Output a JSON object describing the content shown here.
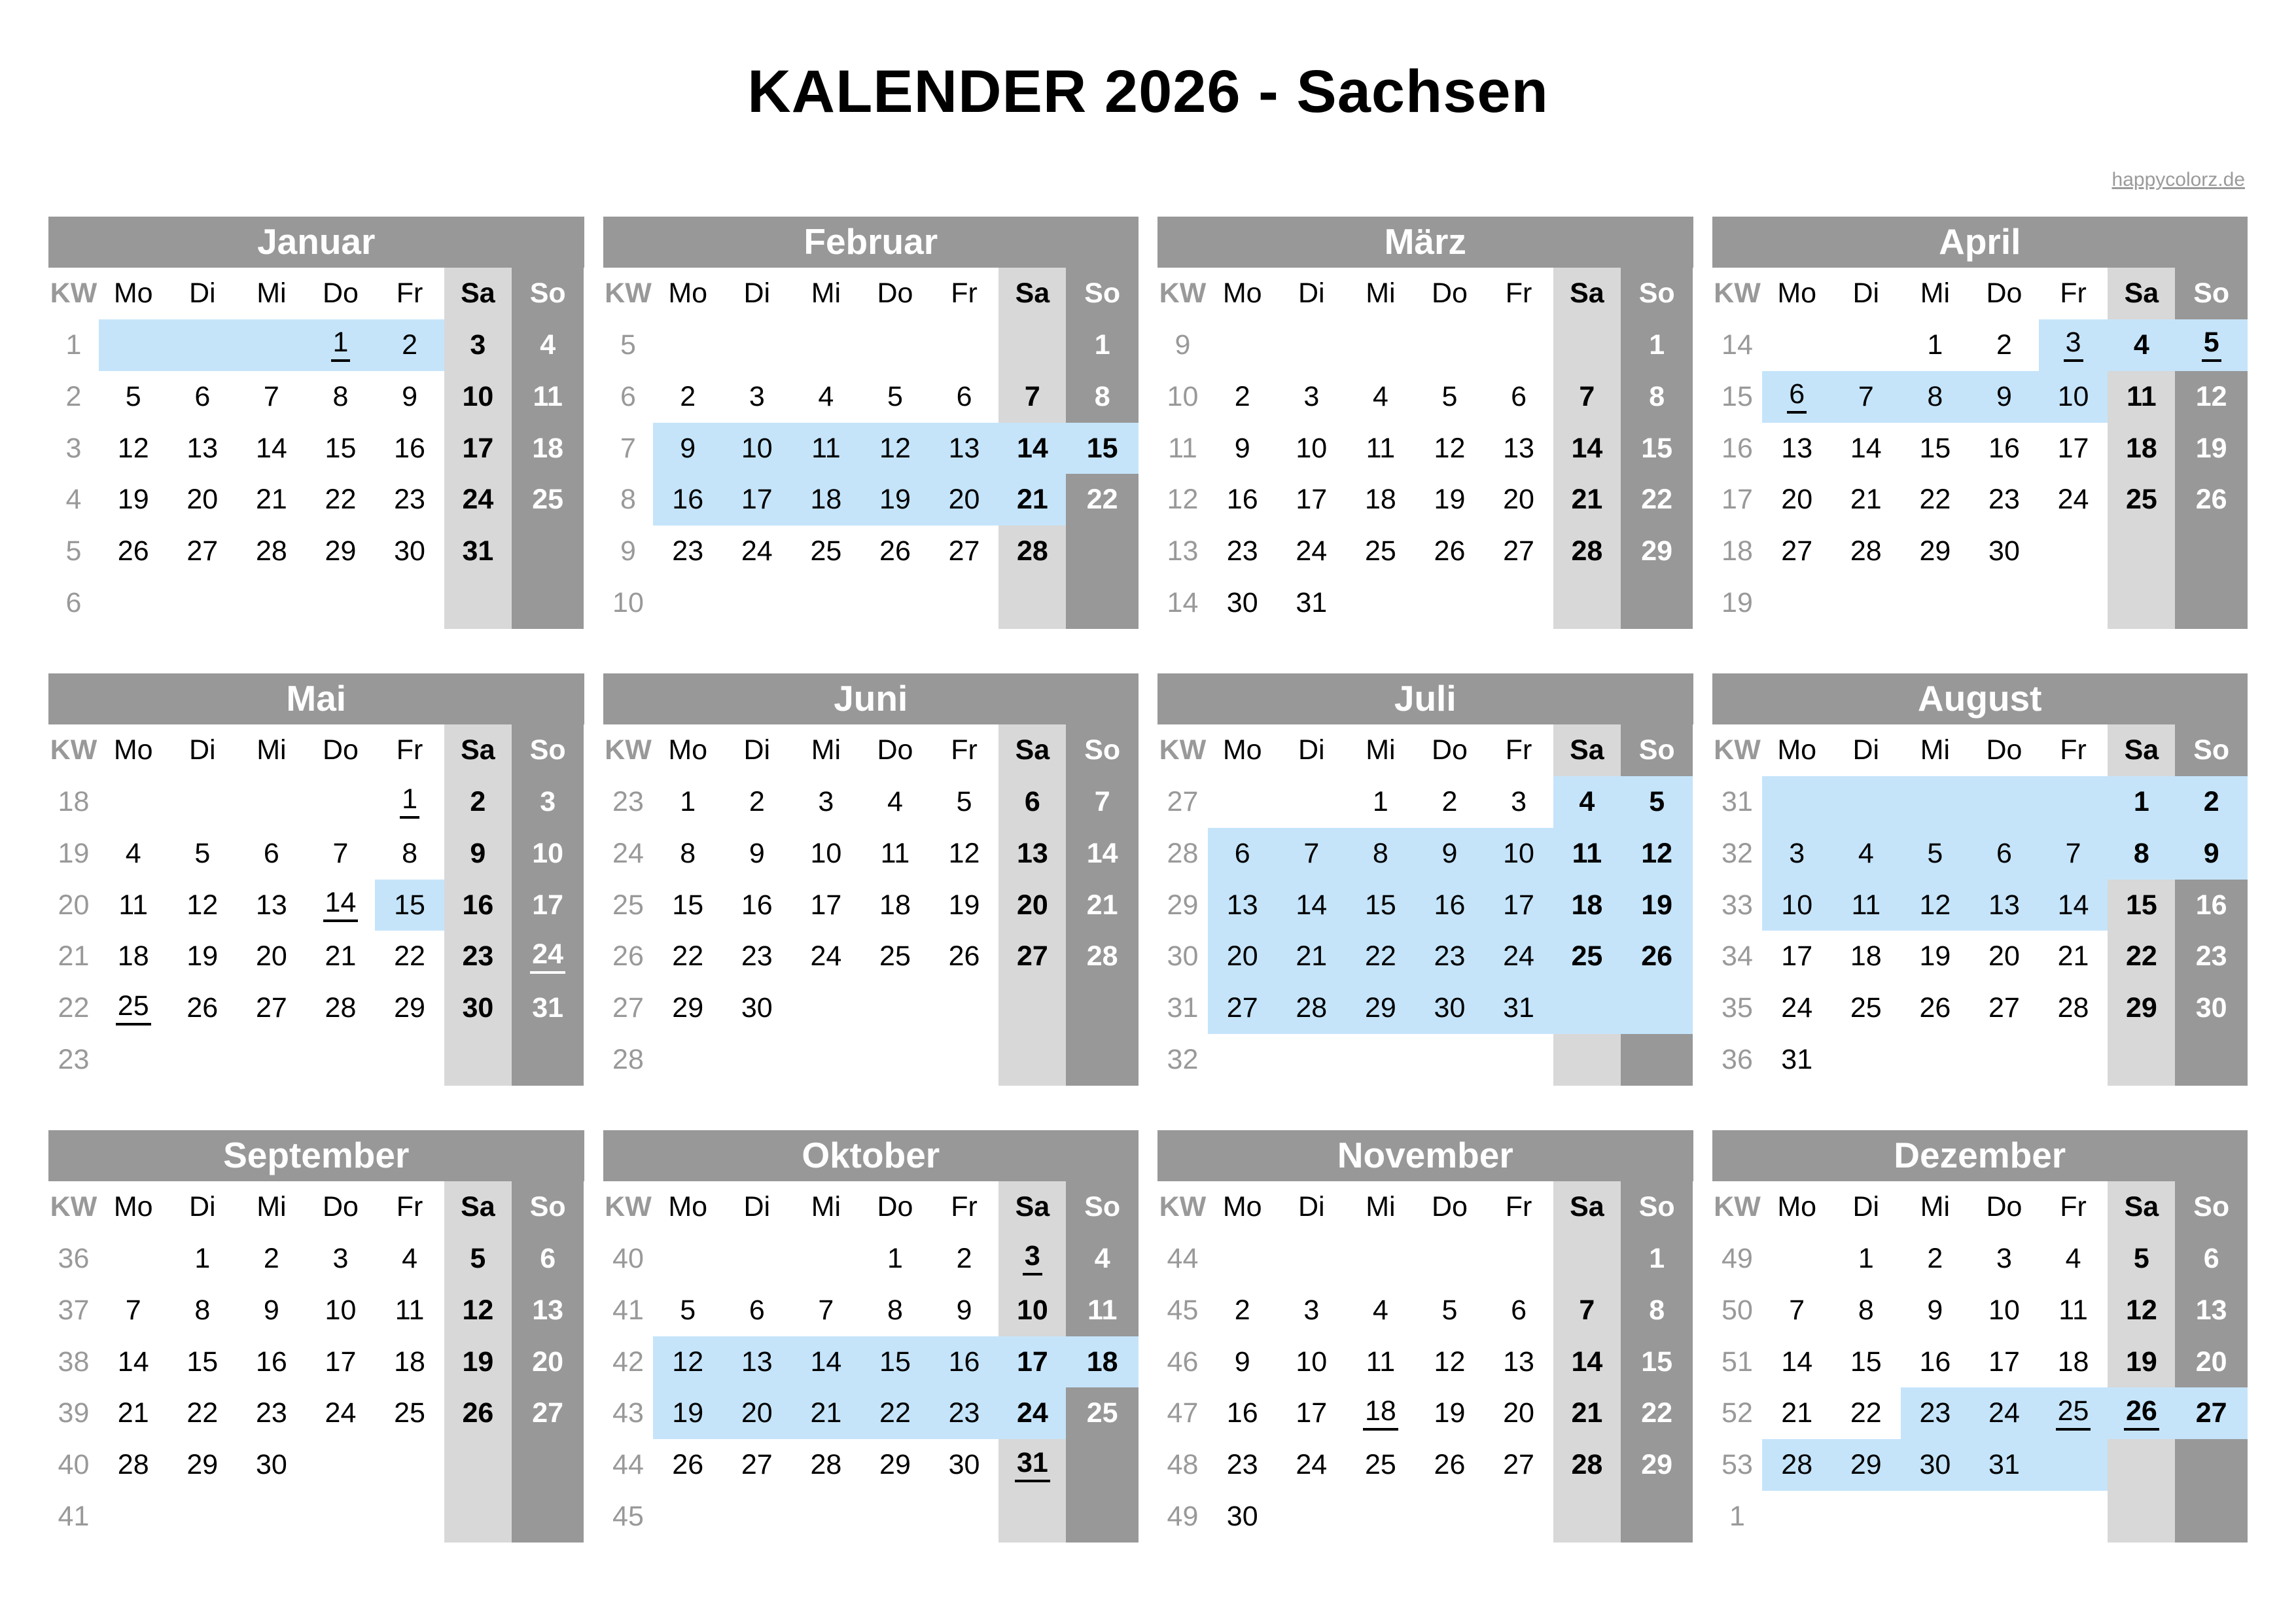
{
  "title": "KALENDER 2026 - Sachsen",
  "link": "happycolorz.de",
  "colors": {
    "header_gray": "#989898",
    "saturday_gray": "#d8d8d8",
    "sunday_gray": "#989898",
    "highlight_blue": "#c5e4fa",
    "kw_text_gray": "#999999"
  },
  "weekday_headers": [
    "KW",
    "Mo",
    "Di",
    "Mi",
    "Do",
    "Fr",
    "Sa",
    "So"
  ],
  "legend_note": "cell token format: digits = day number, u = underlined holiday, h = blue highlight",
  "months": [
    {
      "name": "Januar",
      "kw": [
        "1",
        "2",
        "3",
        "4",
        "5",
        "6"
      ],
      "weeks": [
        [
          "h",
          "h",
          "h",
          "1uh",
          "2h",
          "3",
          "4"
        ],
        [
          "5",
          "6",
          "7",
          "8",
          "9",
          "10",
          "11"
        ],
        [
          "12",
          "13",
          "14",
          "15",
          "16",
          "17",
          "18"
        ],
        [
          "19",
          "20",
          "21",
          "22",
          "23",
          "24",
          "25"
        ],
        [
          "26",
          "27",
          "28",
          "29",
          "30",
          "31",
          ""
        ],
        [
          "",
          "",
          "",
          "",
          "",
          "",
          ""
        ]
      ]
    },
    {
      "name": "Februar",
      "kw": [
        "5",
        "6",
        "7",
        "8",
        "9",
        "10"
      ],
      "weeks": [
        [
          "",
          "",
          "",
          "",
          "",
          "",
          "1"
        ],
        [
          "2",
          "3",
          "4",
          "5",
          "6",
          "7",
          "8"
        ],
        [
          "9h",
          "10h",
          "11h",
          "12h",
          "13h",
          "14h",
          "15h"
        ],
        [
          "16h",
          "17h",
          "18h",
          "19h",
          "20h",
          "21h",
          "22"
        ],
        [
          "23",
          "24",
          "25",
          "26",
          "27",
          "28",
          ""
        ],
        [
          "",
          "",
          "",
          "",
          "",
          "",
          ""
        ]
      ]
    },
    {
      "name": "März",
      "kw": [
        "9",
        "10",
        "11",
        "12",
        "13",
        "14"
      ],
      "weeks": [
        [
          "",
          "",
          "",
          "",
          "",
          "",
          "1"
        ],
        [
          "2",
          "3",
          "4",
          "5",
          "6",
          "7",
          "8"
        ],
        [
          "9",
          "10",
          "11",
          "12",
          "13",
          "14",
          "15"
        ],
        [
          "16",
          "17",
          "18",
          "19",
          "20",
          "21",
          "22"
        ],
        [
          "23",
          "24",
          "25",
          "26",
          "27",
          "28",
          "29"
        ],
        [
          "30",
          "31",
          "",
          "",
          "",
          "",
          ""
        ]
      ]
    },
    {
      "name": "April",
      "kw": [
        "14",
        "15",
        "16",
        "17",
        "18",
        "19"
      ],
      "weeks": [
        [
          "",
          "",
          "1",
          "2",
          "3uh",
          "4h",
          "5uh"
        ],
        [
          "6uh",
          "7h",
          "8h",
          "9h",
          "10h",
          "11",
          "12"
        ],
        [
          "13",
          "14",
          "15",
          "16",
          "17",
          "18",
          "19"
        ],
        [
          "20",
          "21",
          "22",
          "23",
          "24",
          "25",
          "26"
        ],
        [
          "27",
          "28",
          "29",
          "30",
          "",
          "",
          ""
        ],
        [
          "",
          "",
          "",
          "",
          "",
          "",
          ""
        ]
      ]
    },
    {
      "name": "Mai",
      "kw": [
        "18",
        "19",
        "20",
        "21",
        "22",
        "23"
      ],
      "weeks": [
        [
          "",
          "",
          "",
          "",
          "1u",
          "2",
          "3"
        ],
        [
          "4",
          "5",
          "6",
          "7",
          "8",
          "9",
          "10"
        ],
        [
          "11",
          "12",
          "13",
          "14u",
          "15h",
          "16",
          "17"
        ],
        [
          "18",
          "19",
          "20",
          "21",
          "22",
          "23",
          "24u"
        ],
        [
          "25u",
          "26",
          "27",
          "28",
          "29",
          "30",
          "31"
        ],
        [
          "",
          "",
          "",
          "",
          "",
          "",
          ""
        ]
      ]
    },
    {
      "name": "Juni",
      "kw": [
        "23",
        "24",
        "25",
        "26",
        "27",
        "28"
      ],
      "weeks": [
        [
          "1",
          "2",
          "3",
          "4",
          "5",
          "6",
          "7"
        ],
        [
          "8",
          "9",
          "10",
          "11",
          "12",
          "13",
          "14"
        ],
        [
          "15",
          "16",
          "17",
          "18",
          "19",
          "20",
          "21"
        ],
        [
          "22",
          "23",
          "24",
          "25",
          "26",
          "27",
          "28"
        ],
        [
          "29",
          "30",
          "",
          "",
          "",
          "",
          ""
        ],
        [
          "",
          "",
          "",
          "",
          "",
          "",
          ""
        ]
      ]
    },
    {
      "name": "Juli",
      "kw": [
        "27",
        "28",
        "29",
        "30",
        "31",
        "32"
      ],
      "weeks": [
        [
          "",
          "",
          "1",
          "2",
          "3",
          "4h",
          "5h"
        ],
        [
          "6h",
          "7h",
          "8h",
          "9h",
          "10h",
          "11h",
          "12h"
        ],
        [
          "13h",
          "14h",
          "15h",
          "16h",
          "17h",
          "18h",
          "19h"
        ],
        [
          "20h",
          "21h",
          "22h",
          "23h",
          "24h",
          "25h",
          "26h"
        ],
        [
          "27h",
          "28h",
          "29h",
          "30h",
          "31h",
          "h",
          "h"
        ],
        [
          "",
          "",
          "",
          "",
          "",
          "",
          ""
        ]
      ]
    },
    {
      "name": "August",
      "kw": [
        "31",
        "32",
        "33",
        "34",
        "35",
        "36"
      ],
      "weeks": [
        [
          "h",
          "h",
          "h",
          "h",
          "h",
          "1h",
          "2h"
        ],
        [
          "3h",
          "4h",
          "5h",
          "6h",
          "7h",
          "8h",
          "9h"
        ],
        [
          "10h",
          "11h",
          "12h",
          "13h",
          "14h",
          "15",
          "16"
        ],
        [
          "17",
          "18",
          "19",
          "20",
          "21",
          "22",
          "23"
        ],
        [
          "24",
          "25",
          "26",
          "27",
          "28",
          "29",
          "30"
        ],
        [
          "31",
          "",
          "",
          "",
          "",
          "",
          ""
        ]
      ]
    },
    {
      "name": "September",
      "kw": [
        "36",
        "37",
        "38",
        "39",
        "40",
        "41"
      ],
      "weeks": [
        [
          "",
          "1",
          "2",
          "3",
          "4",
          "5",
          "6"
        ],
        [
          "7",
          "8",
          "9",
          "10",
          "11",
          "12",
          "13"
        ],
        [
          "14",
          "15",
          "16",
          "17",
          "18",
          "19",
          "20"
        ],
        [
          "21",
          "22",
          "23",
          "24",
          "25",
          "26",
          "27"
        ],
        [
          "28",
          "29",
          "30",
          "",
          "",
          "",
          ""
        ],
        [
          "",
          "",
          "",
          "",
          "",
          "",
          ""
        ]
      ]
    },
    {
      "name": "Oktober",
      "kw": [
        "40",
        "41",
        "42",
        "43",
        "44",
        "45"
      ],
      "weeks": [
        [
          "",
          "",
          "",
          "1",
          "2",
          "3u",
          "4"
        ],
        [
          "5",
          "6",
          "7",
          "8",
          "9",
          "10",
          "11"
        ],
        [
          "12h",
          "13h",
          "14h",
          "15h",
          "16h",
          "17h",
          "18h"
        ],
        [
          "19h",
          "20h",
          "21h",
          "22h",
          "23h",
          "24h",
          "25"
        ],
        [
          "26",
          "27",
          "28",
          "29",
          "30",
          "31u",
          ""
        ],
        [
          "",
          "",
          "",
          "",
          "",
          "",
          ""
        ]
      ]
    },
    {
      "name": "November",
      "kw": [
        "44",
        "45",
        "46",
        "47",
        "48",
        "49"
      ],
      "weeks": [
        [
          "",
          "",
          "",
          "",
          "",
          "",
          "1"
        ],
        [
          "2",
          "3",
          "4",
          "5",
          "6",
          "7",
          "8"
        ],
        [
          "9",
          "10",
          "11",
          "12",
          "13",
          "14",
          "15"
        ],
        [
          "16",
          "17",
          "18u",
          "19",
          "20",
          "21",
          "22"
        ],
        [
          "23",
          "24",
          "25",
          "26",
          "27",
          "28",
          "29"
        ],
        [
          "30",
          "",
          "",
          "",
          "",
          "",
          ""
        ]
      ]
    },
    {
      "name": "Dezember",
      "kw": [
        "49",
        "50",
        "51",
        "52",
        "53",
        "1"
      ],
      "weeks": [
        [
          "",
          "1",
          "2",
          "3",
          "4",
          "5",
          "6"
        ],
        [
          "7",
          "8",
          "9",
          "10",
          "11",
          "12",
          "13"
        ],
        [
          "14",
          "15",
          "16",
          "17",
          "18",
          "19",
          "20"
        ],
        [
          "21",
          "22",
          "23h",
          "24h",
          "25uh",
          "26uh",
          "27h"
        ],
        [
          "28h",
          "29h",
          "30h",
          "31h",
          "h",
          "",
          ""
        ],
        [
          "",
          "",
          "",
          "",
          "",
          "",
          ""
        ]
      ]
    }
  ]
}
